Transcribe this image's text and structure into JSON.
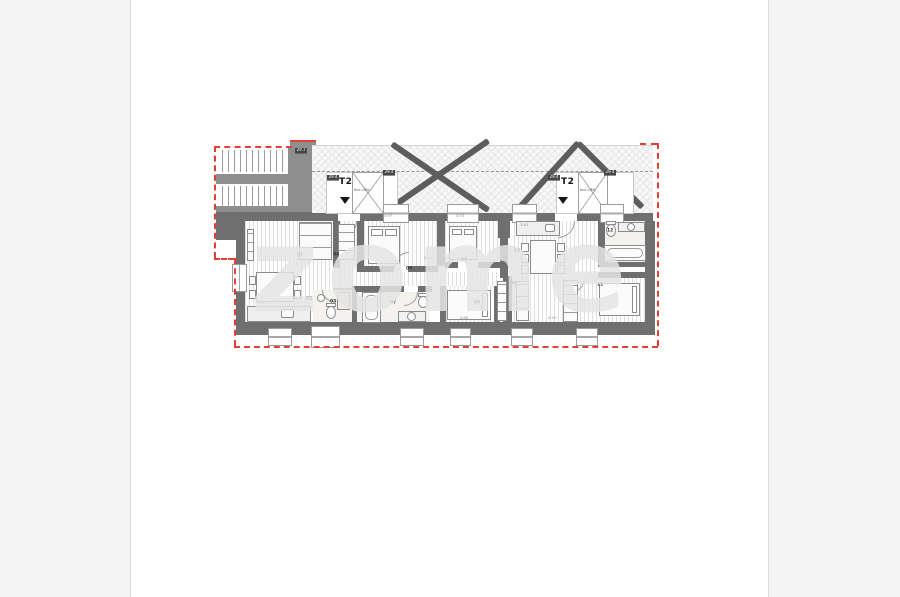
{
  "watermark": {
    "text": "zome"
  },
  "units": [
    {
      "name": "T2",
      "incl": "Incl.=8%"
    },
    {
      "name": "T2",
      "incl": "Incl.=8%"
    }
  ],
  "area_badges": [
    {
      "text": "29.7",
      "x": 295,
      "y": 148
    },
    {
      "text": "29.4",
      "x": 327,
      "y": 175
    },
    {
      "text": "29.4",
      "x": 383,
      "y": 170
    },
    {
      "text": "29.4",
      "x": 548,
      "y": 175
    },
    {
      "text": "29.4",
      "x": 604,
      "y": 170
    }
  ],
  "room_numbers": [
    {
      "n": "01",
      "x": 297,
      "y": 252
    },
    {
      "n": "02",
      "x": 306,
      "y": 296
    },
    {
      "n": "03",
      "x": 330,
      "y": 299
    },
    {
      "n": "04",
      "x": 333,
      "y": 252
    },
    {
      "n": "05",
      "x": 406,
      "y": 266
    },
    {
      "n": "06",
      "x": 461,
      "y": 257
    },
    {
      "n": "07",
      "x": 390,
      "y": 300
    },
    {
      "n": "08",
      "x": 474,
      "y": 300
    },
    {
      "n": "09",
      "x": 510,
      "y": 281
    },
    {
      "n": "10",
      "x": 514,
      "y": 248
    },
    {
      "n": "11",
      "x": 597,
      "y": 282
    },
    {
      "n": "12",
      "x": 607,
      "y": 228
    }
  ],
  "dimensions": [
    {
      "t": "4.97",
      "x": 384,
      "y": 214
    },
    {
      "t": "4.53",
      "x": 456,
      "y": 214
    },
    {
      "t": "3.63",
      "x": 520,
      "y": 223
    },
    {
      "t": "2.03",
      "x": 424,
      "y": 256
    },
    {
      "t": "3.51",
      "x": 258,
      "y": 301
    },
    {
      "t": "4.88",
      "x": 460,
      "y": 316
    },
    {
      "t": "4.55",
      "x": 548,
      "y": 316
    },
    {
      "t": "3.15",
      "x": 610,
      "y": 265
    }
  ],
  "colors": {
    "wall": "#6f6f6f",
    "boundary": "#e34033",
    "watermark": "#e5e5e5",
    "badge_bg": "#474747"
  }
}
